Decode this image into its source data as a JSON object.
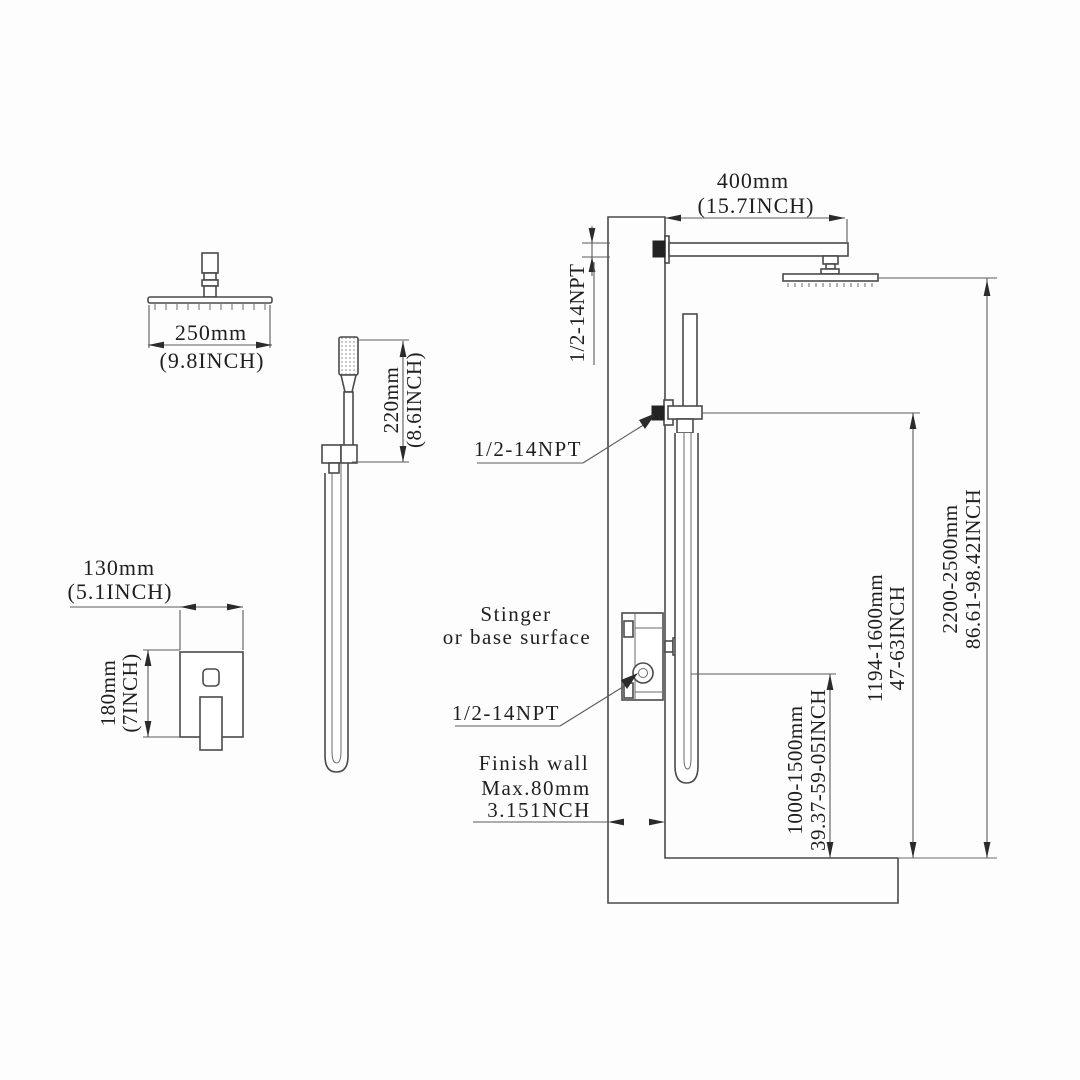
{
  "style": {
    "background": "#fdfdfd",
    "line_color": "#4a4a4a",
    "hatch_color": "#a3a3a3",
    "text_color": "#1f1f1f"
  },
  "dims": {
    "arm": {
      "mm": "400mm",
      "inch": "(15.7INCH)"
    },
    "head": {
      "mm": "250mm",
      "inch": "(9.8INCH)"
    },
    "hand": {
      "mm": "220mm",
      "inch": "(8.6INCH)"
    },
    "valve_width": {
      "mm": "130mm",
      "inch": "(5.1INCH)"
    },
    "valve_height": {
      "mm": "180mm",
      "inch": "(7INCH)"
    },
    "valve_install_height": {
      "mm": "1000-1500mm",
      "inch": "39.37-59-05INCH"
    },
    "holder_install_height": {
      "mm": "1194-1600mm",
      "inch": "47-63INCH"
    },
    "head_install_height": {
      "mm": "2200-2500mm",
      "inch": "86.61-98.42INCH"
    }
  },
  "labels": {
    "arm_thread": "1/2-14NPT",
    "outlet_thread": "1/2-14NPT",
    "valve_thread": "1/2-14NPT",
    "wall_line1": "Stinger",
    "wall_line2": "or base surface",
    "finish_wall_line1": "Finish wall",
    "finish_wall_line2": "Max.80mm",
    "finish_wall_line3": "3.151NCH"
  }
}
